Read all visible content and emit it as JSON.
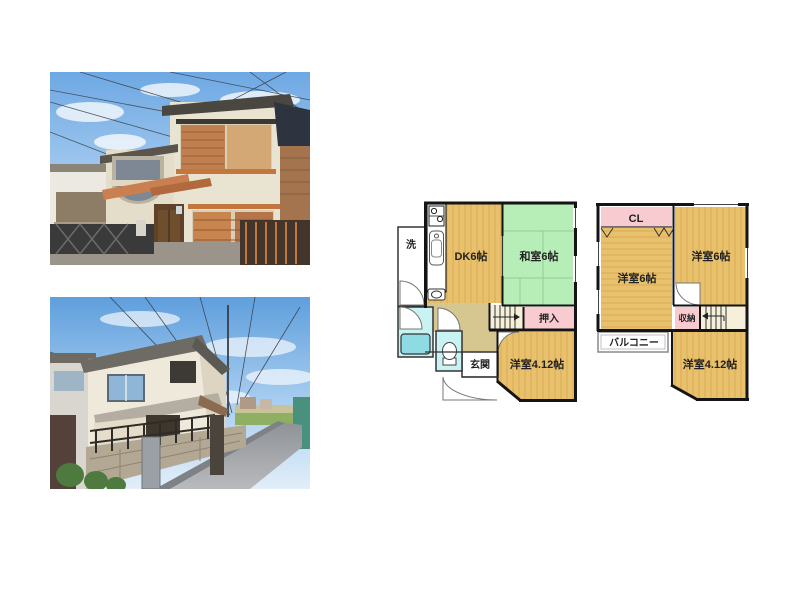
{
  "floorplan": {
    "floor1": {
      "laundry": "洗",
      "dk": "DK6帖",
      "washitsu": "和室6帖",
      "oshiire": "押入",
      "genkan": "玄関",
      "yoshitsu412": "洋室4.12帖"
    },
    "floor2": {
      "cl": "CL",
      "yoshitsu6_left": "洋室6帖",
      "yoshitsu6_right": "洋室6帖",
      "shuno": "収納",
      "balcony": "バルコニー",
      "yoshitsu412": "洋室4.12帖"
    },
    "colors": {
      "wood_floor": "#e9c16c",
      "tatami": "#b7edb7",
      "closet_pink": "#f8cbd0",
      "wet_area_cyan": "#c9f2f2",
      "bathtub_cyan": "#8edbe3",
      "hall_tan": "#d6c68f",
      "stair_cream": "#f6f0da",
      "wall": "#141414"
    }
  }
}
